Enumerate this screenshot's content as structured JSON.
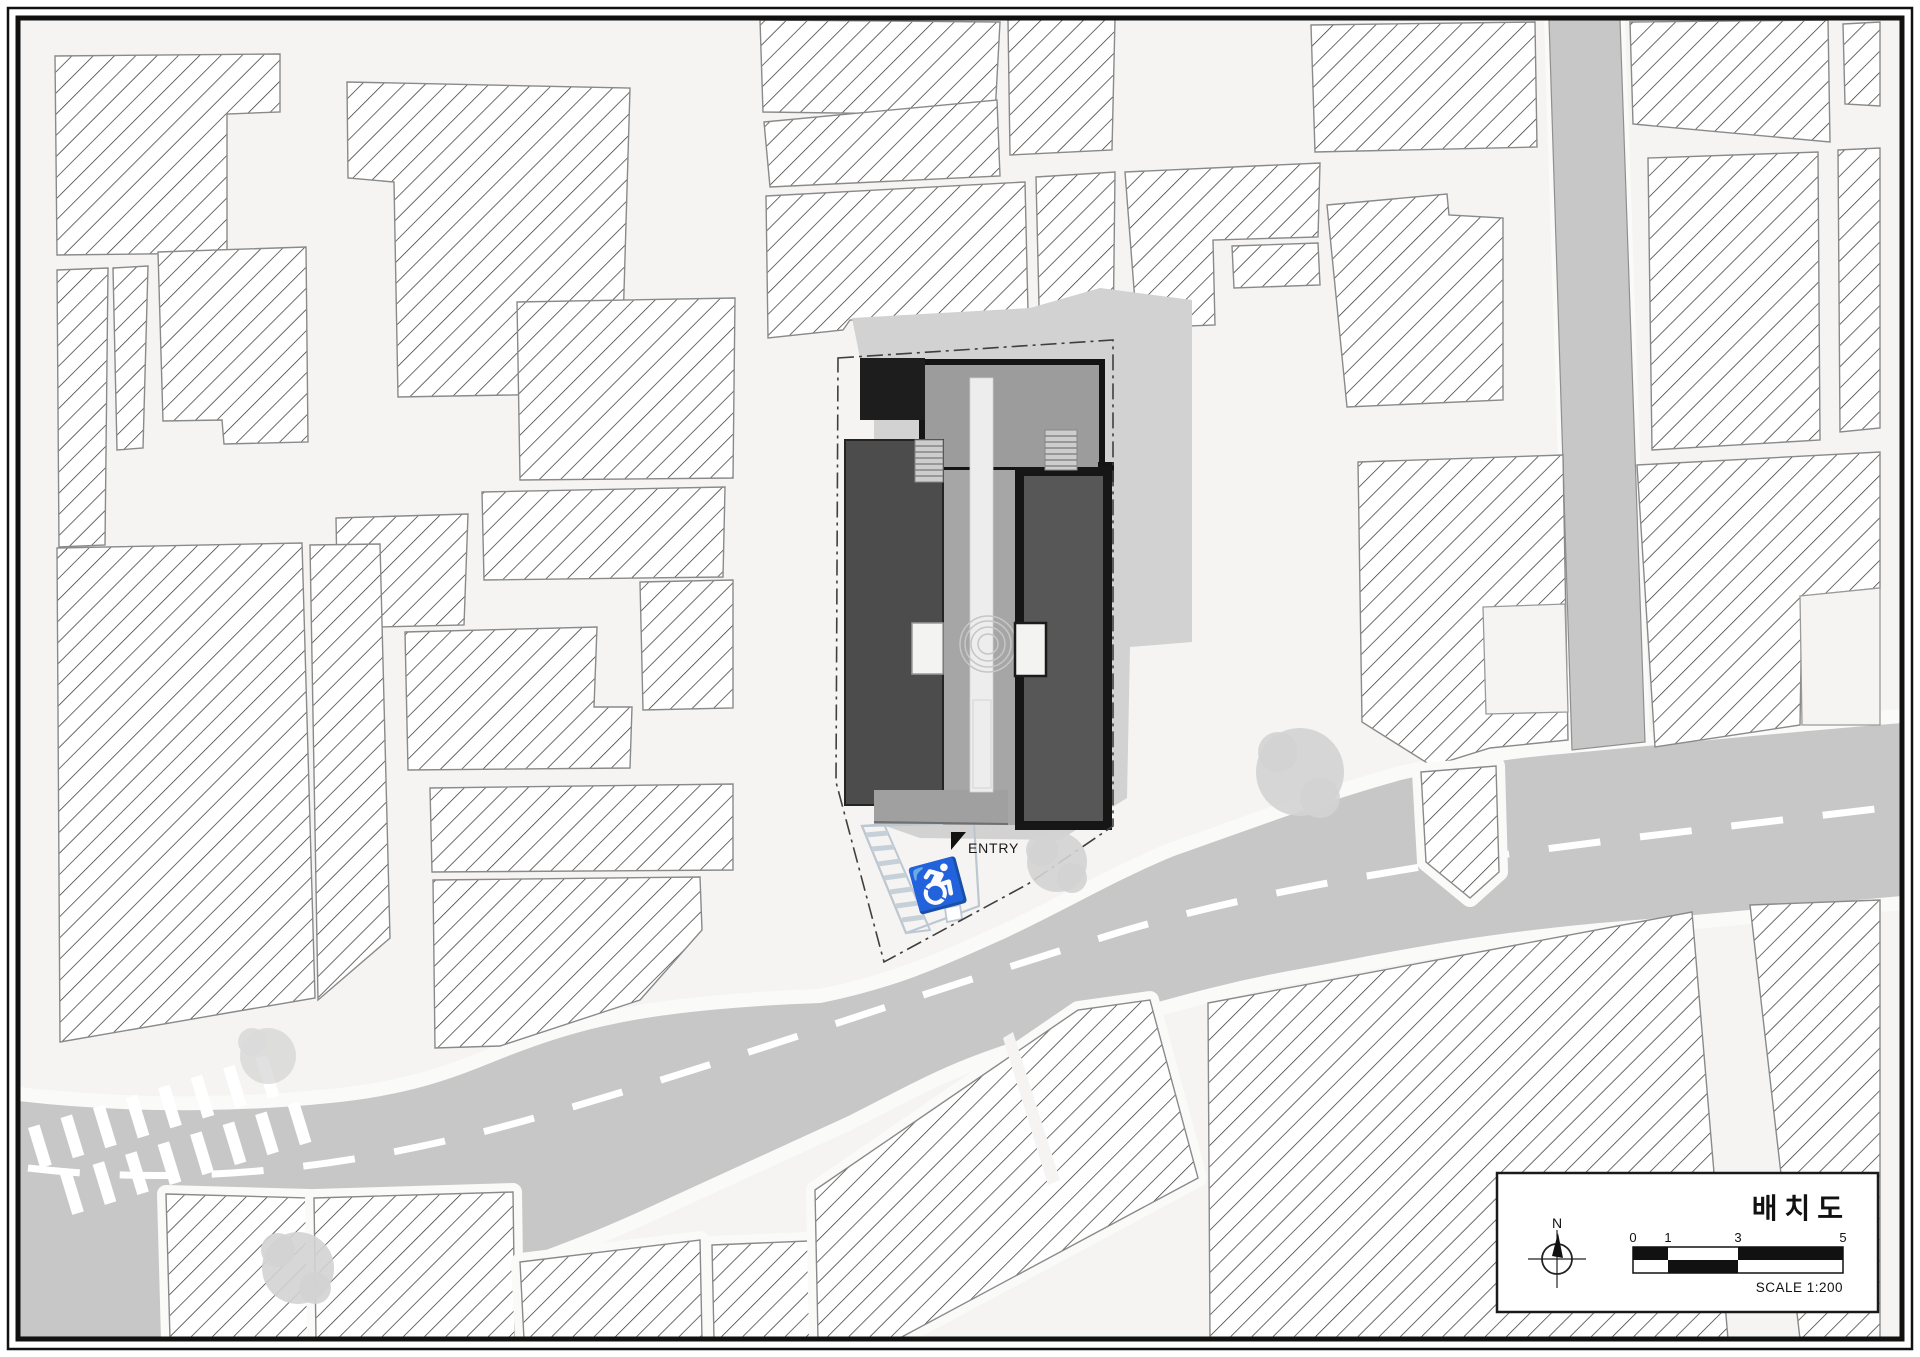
{
  "drawing": {
    "title": "배치도",
    "scale_label": "SCALE 1:200",
    "north_label": "N",
    "entry_label": "ENTRY",
    "scale_ticks": [
      "0",
      "1",
      "3",
      "5"
    ]
  },
  "legend": {
    "colors": {
      "background": "#f5f4f2",
      "road": "#c7c7c7",
      "site_shadow": "#d2d2d2",
      "roof_gray": "#9c9c9c",
      "wing_dark": "#4c4c4c",
      "wing_medium": "#575757",
      "core_black": "#1d1d1d",
      "parking_accent": "#bcc7d1",
      "tree": "#d3d3d3",
      "hatch_line": "#2e2e2e",
      "centerline": "#ffffff"
    }
  }
}
